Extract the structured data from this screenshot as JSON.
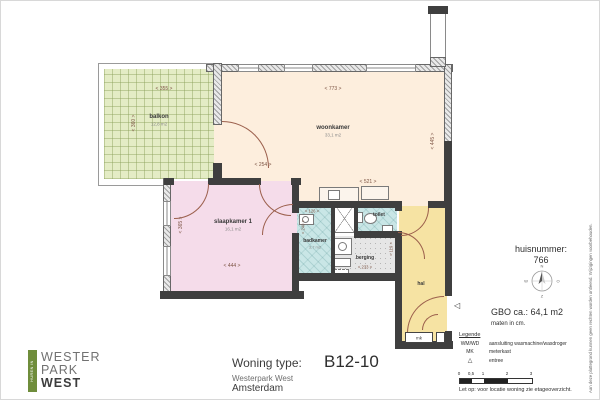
{
  "colors": {
    "balkon": "#e4ecc5",
    "woonkamer": "#fdeedd",
    "slaapkamer": "#f5dcea",
    "badkamer": "#c9e6e6",
    "berging": "#e6e6e6",
    "hal": "#f6e3a3",
    "wall": "#3f3f3f",
    "door_arc": "#9b5f4c",
    "logo_green": "#6f8d3b"
  },
  "plan": {
    "rooms": {
      "balkon": {
        "name": "balkon",
        "area": "12,8 m2"
      },
      "woonkamer": {
        "name": "woonkamer",
        "area": "33,1 m2"
      },
      "slaapkamer1": {
        "name": "slaapkamer 1",
        "area": "16,1 m2"
      },
      "badkamer": {
        "name": "badkamer",
        "area": "3,7 m2"
      },
      "toilet": {
        "name": "toilet"
      },
      "berging": {
        "name": "berging"
      },
      "hal": {
        "name": "hal"
      },
      "meterkast": {
        "name": "mk"
      }
    },
    "dimensions": {
      "balkon_width": "< 355 >",
      "balkon_depth": "< 360 >",
      "woonkamer_width": "< 773 >",
      "woonkamer_depth": "< 445 >",
      "balkon_door": "< 254 >",
      "keuken_width": "< 521 >",
      "slaapkamer_width": "< 444 >",
      "slaapkamer_depth": "< 365 >",
      "badkamer_width": "< 126 >",
      "badkamer_depth": "< 240 >",
      "berging_width": "< 233 >",
      "berging_depth": "< 119 >"
    },
    "entree_marker": "◁"
  },
  "info": {
    "huisnummer_label": "huisnummer:",
    "huisnummer": "766",
    "gbo": "GBO ca.:  64,1 m2",
    "maten": "maten in cm.",
    "disclaimer": "Aan deze plattegrond kunnen geen rechten worden ontleend. Wijzigingen voorbehouden.",
    "compass": {
      "n": "N",
      "e": "O",
      "s": "Z",
      "w": "W"
    }
  },
  "legend": {
    "title": "Legende",
    "items": [
      {
        "symbol": "WM/WD",
        "desc": "aansluiting wasmachine/wasdroger"
      },
      {
        "symbol": "MK",
        "desc": "meterkast"
      },
      {
        "symbol": "△",
        "desc": "entree"
      }
    ],
    "scale_ticks": [
      "0",
      "0,5",
      "1",
      "2",
      "3"
    ],
    "note": "Let op:  voor locatie woning zie etageoverzicht."
  },
  "title_block": {
    "label": "Woning type:",
    "value": "B12-10",
    "project": "Westerpark West",
    "city": "Amsterdam"
  },
  "logo": {
    "vertical": "HUREN IN",
    "line1": "WESTER",
    "line2": "PARK",
    "line3": "WEST"
  }
}
